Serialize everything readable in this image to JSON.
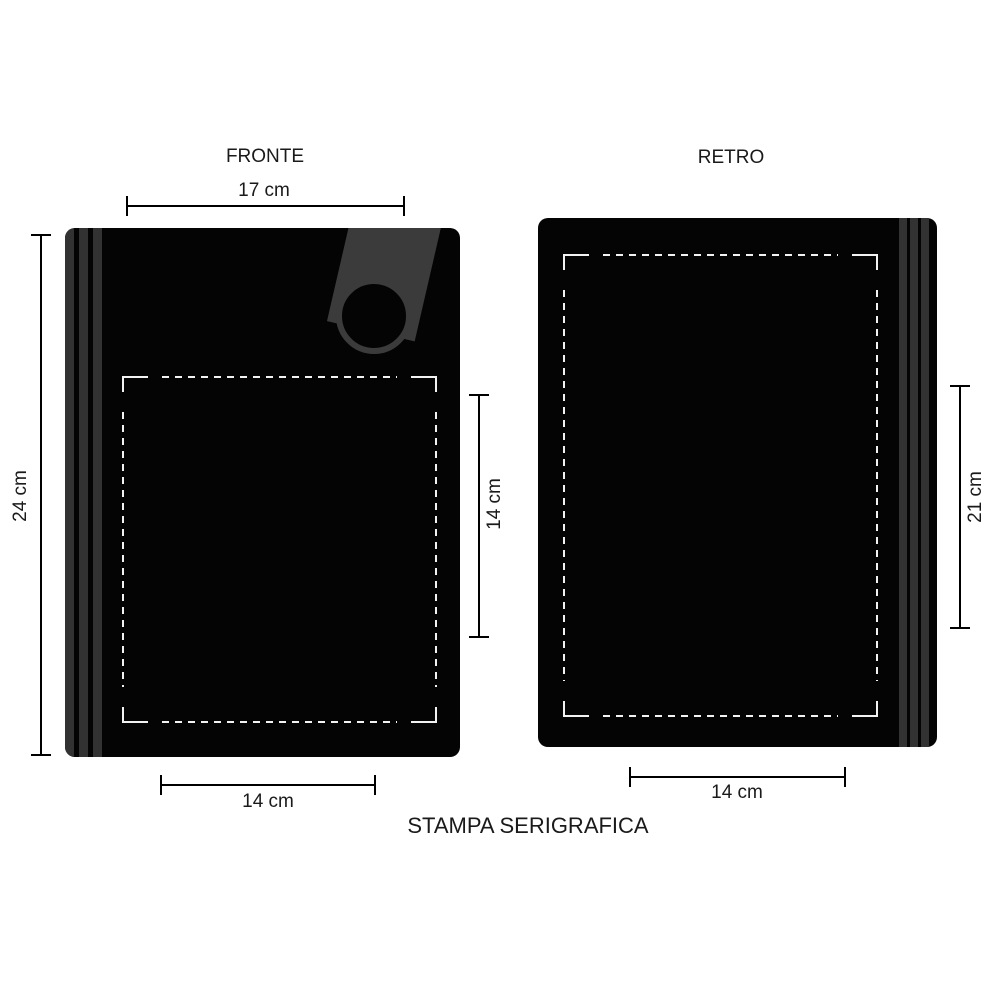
{
  "title": "STAMPA SERIGRAFICA",
  "front": {
    "label": "FRONTE",
    "width_dim": "17 cm",
    "height_dim": "24 cm",
    "print_area": {
      "height_dim": "14 cm",
      "width_dim": "14 cm"
    }
  },
  "back": {
    "label": "RETRO",
    "print_area": {
      "height_dim": "21 cm",
      "width_dim": "14 cm"
    }
  },
  "colors": {
    "bag": "#040404",
    "stripe": "#323232",
    "strap": "#3b3b3b",
    "dash": "#f2f2f2",
    "dim": "#000000",
    "text": "#1a1a1a",
    "page": "#ffffff"
  }
}
